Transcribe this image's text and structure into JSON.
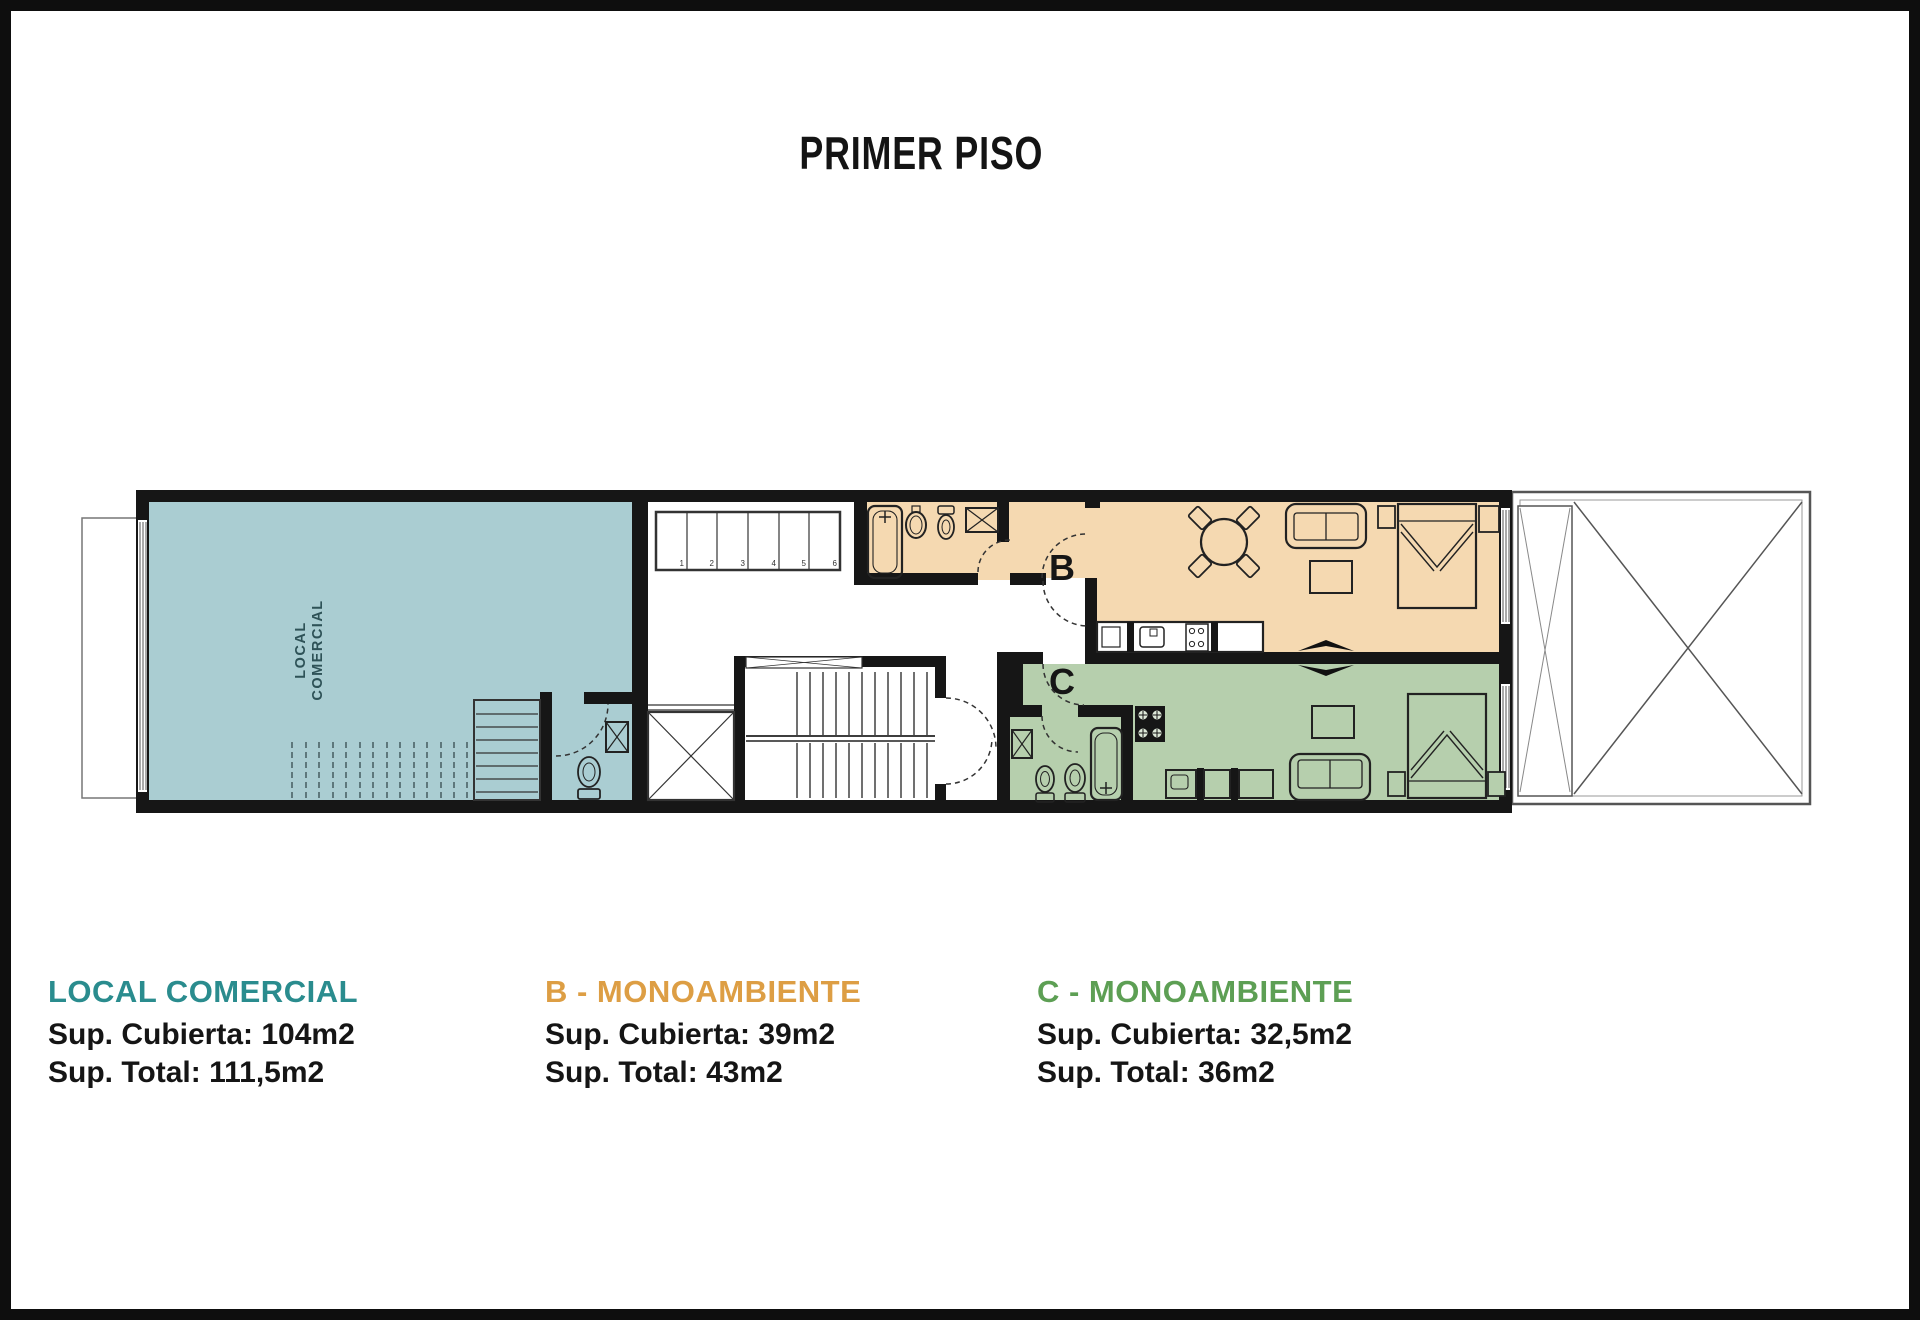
{
  "title": "PRIMER PISO",
  "plan": {
    "local_label_line1": "LOCAL",
    "local_label_line2": "COMERCIAL",
    "unit_b_letter": "B",
    "unit_c_letter": "C",
    "locker_numbers": [
      "1",
      "2",
      "3",
      "4",
      "5",
      "6"
    ]
  },
  "colors": {
    "legend_local": "#2a8c8e",
    "legend_unit_b": "#dd9e44",
    "legend_unit_c": "#5d9f54",
    "fill_local": "#aacdd2",
    "fill_unit_b": "#f5d9b1",
    "fill_unit_c": "#b6cfad",
    "wall": "#161616"
  },
  "legend": [
    {
      "name": "LOCAL COMERCIAL",
      "covered": "Sup. Cubierta: 104m2",
      "total": "Sup. Total: 111,5m2"
    },
    {
      "name": "B - MONOAMBIENTE",
      "covered": "Sup. Cubierta: 39m2",
      "total": "Sup. Total: 43m2"
    },
    {
      "name": "C - MONOAMBIENTE",
      "covered": "Sup. Cubierta: 32,5m2",
      "total": "Sup. Total: 36m2"
    }
  ]
}
